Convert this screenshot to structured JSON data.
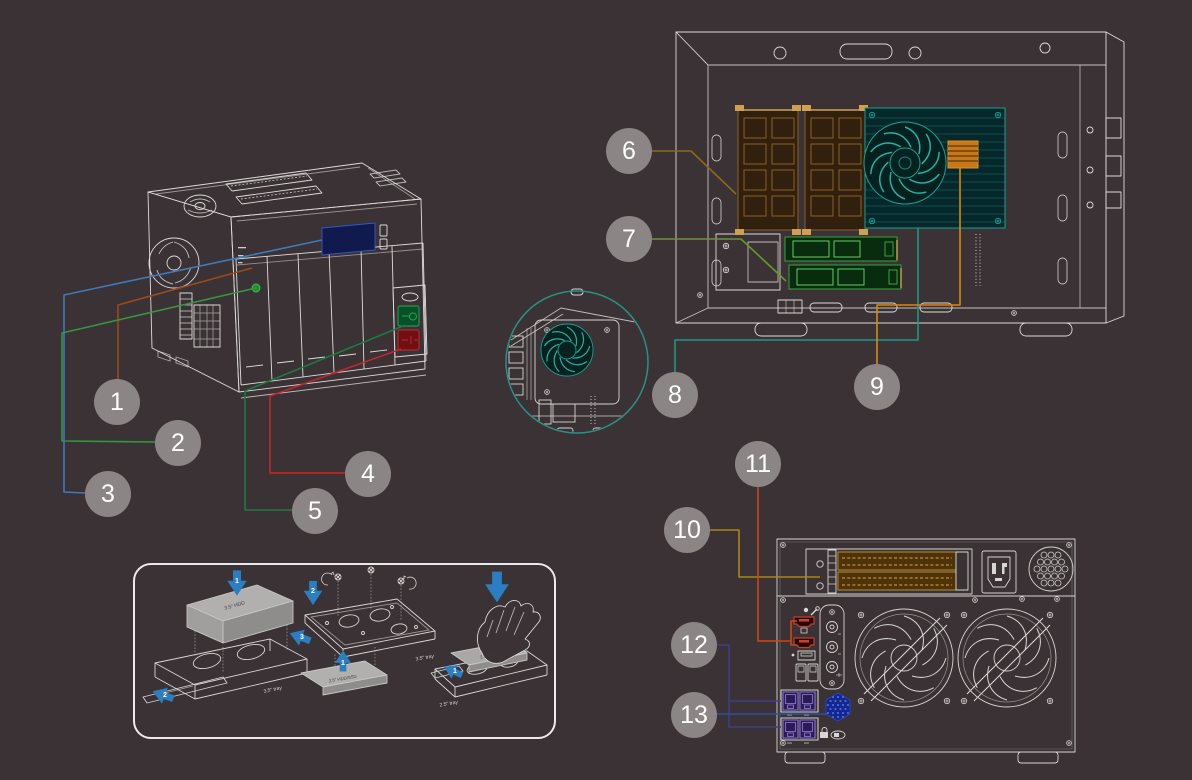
{
  "canvas": {
    "width": 1192,
    "height": 780,
    "background_color": "#3a3234"
  },
  "palette": {
    "line_art": "#dedcda",
    "callout_circle": "#8b8585",
    "callout_number": "#ffffff",
    "lcd_highlight": "#3658c0",
    "usb_copy_green": "#1e8f33",
    "power_button_green": "#2aa852",
    "reset_button_red": "#cc2a30",
    "ram_highlight": "#8a5f28",
    "cooler_highlight": "#17a096",
    "heatsink_highlight": "#c87818",
    "m2_highlight": "#3aa244",
    "pcie_slot_highlight": "#bd8f2a",
    "hdmi_highlight": "#c8402a",
    "ethernet_highlight": "#8672cc",
    "speaker_highlight": "#2a46c8",
    "inset_ring": "#2a9088",
    "arrow_blue": "#2b7ec1"
  },
  "callouts": [
    {
      "num": "1",
      "line_color": "#9a4a1e",
      "target": "front-led-indicators"
    },
    {
      "num": "2",
      "line_color": "#38953f",
      "target": "usb-one-touch-copy"
    },
    {
      "num": "3",
      "line_color": "#3f7ab8",
      "target": "lcd-panel"
    },
    {
      "num": "4",
      "line_color": "#c5262c",
      "target": "reset-button"
    },
    {
      "num": "5",
      "line_color": "#1c7a42",
      "target": "power-button"
    },
    {
      "num": "6",
      "line_color": "#8a6a14",
      "target": "ram-modules"
    },
    {
      "num": "7",
      "line_color": "#649a2a",
      "target": "m2-ssd-slots"
    },
    {
      "num": "8",
      "line_color": "#1d968c",
      "target": "cpu-fan"
    },
    {
      "num": "9",
      "line_color": "#d8890f",
      "target": "cpu-heatsink"
    },
    {
      "num": "10",
      "line_color": "#aa861a",
      "target": "pcie-expansion-slots"
    },
    {
      "num": "11",
      "line_color": "#c8481c",
      "target": "hdmi-ports"
    },
    {
      "num": "12",
      "line_color": "#3c3c88",
      "target": "ethernet-ports"
    },
    {
      "num": "13",
      "line_color": "#2d4f9e",
      "target": "speaker"
    }
  ],
  "tray_guide": {
    "labels": {
      "hdd_35": "3.5\" HDD",
      "tray_35_left": "3.5\" tray",
      "hdd_ssd_25": "2.5\" HDD/SSD",
      "tray_35_mid": "3.5\" tray",
      "ssd_25": "2.5\" SSD",
      "tray_25": "2.5\" tray"
    },
    "steps": {
      "left_1": "1",
      "left_2": "2",
      "left_3": "3",
      "mid_1": "1",
      "mid_2": "2",
      "right_1": "1"
    }
  }
}
